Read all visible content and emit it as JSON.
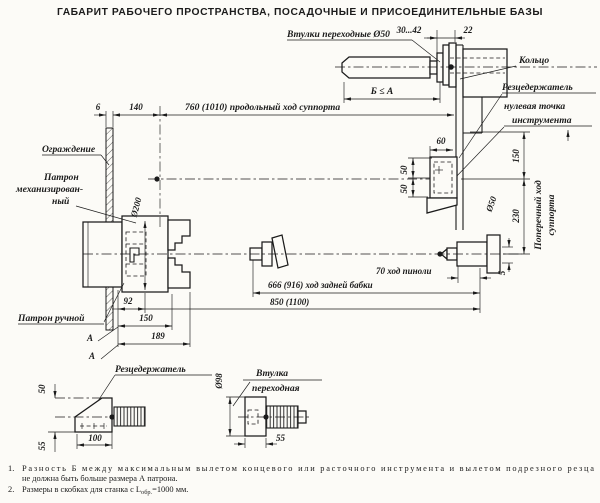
{
  "colors": {
    "ink": "#1b1b1b",
    "paper": "#fcfbf7"
  },
  "title": "ГАБАРИТ РАБОЧЕГО ПРОСТРАНСТВА, ПОСАДОЧНЫЕ И ПРИСОЕДИНИТЕЛЬНЫЕ БАЗЫ",
  "top": {
    "sleeve_label": "Втулки переходные Ø50",
    "dim_bore": "30...42",
    "dim_ring": "22",
    "ring_label": "Кольцо",
    "toolpost_label": "Резцедержатель",
    "zero_point_line1": "нулевая точка",
    "zero_point_line2": "инструмента",
    "b_le_a": "Б ≤ А"
  },
  "main": {
    "dim_guard": "6",
    "dim_140": "140",
    "longitudinal_travel": "760 (1010) продольный ход суппорта",
    "guard_label": "Ограждение",
    "chuck_label_1": "Патрон",
    "chuck_label_2": "механизирован-",
    "chuck_label_3": "ный",
    "chuck_dia": "Ø200",
    "manual_chuck_label": "Патрон ручной",
    "dim_92": "92",
    "dim_150_left": "150",
    "dim_189": "189",
    "section_a1": "А",
    "section_a2": "А",
    "quill_travel": "70 ход пиноли",
    "tailstock_travel": "666 (916) ход задней бабки",
    "dim_850": "850 (1100)",
    "dim_60": "60",
    "dim_50_upper": "50",
    "dim_50_lower": "50",
    "dim_150_right": "150",
    "dim_230": "230",
    "quill_dia": "Ø50",
    "cross_travel_1": "Поперечный ход",
    "cross_travel_2": "суппорта",
    "dim_5": "5"
  },
  "det1": {
    "label": "Резцедержатель",
    "dim_50": "50",
    "dim_55": "55",
    "dim_100": "100"
  },
  "det2": {
    "label_1": "Втулка",
    "label_2": "переходная",
    "dia": "Ø98",
    "dim_55": "55"
  },
  "notes": {
    "n1_num": "1.",
    "n1_line1": "Разность Б между максимальным вылетом концевого или расточного инструмента и вылетом подрезного резца",
    "n1_line2": "не должна быть больше размера А патрона.",
    "n2_num": "2.",
    "n2_prefix": "Размеры в скобках для станка с L",
    "n2_sub": "обр.",
    "n2_suffix": "=1000 мм."
  }
}
